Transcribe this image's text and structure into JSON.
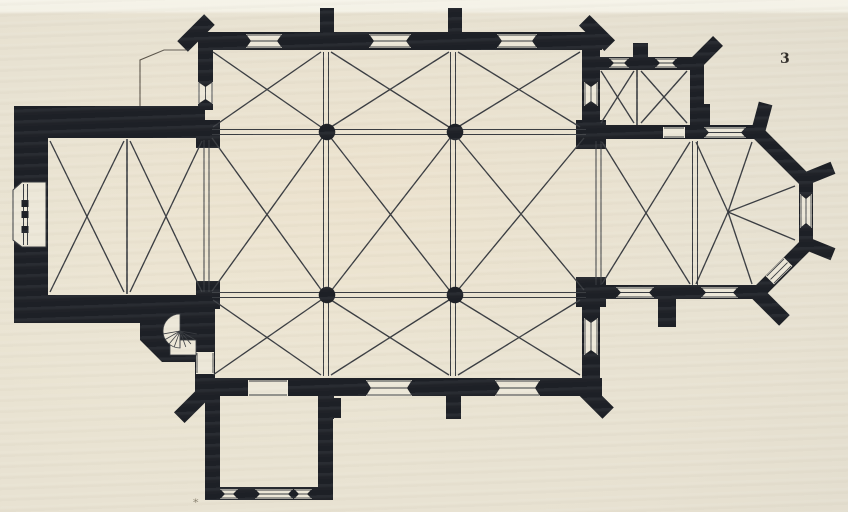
{
  "meta": {
    "figure_number": "3",
    "caption_mark": "*"
  },
  "colors": {
    "paper": "#e8e2d2",
    "paper_open": "#ece7d8",
    "ink": "#1d2026",
    "line": "#393c41",
    "outline": "#5a544a"
  },
  "plan": {
    "annex_outline": [
      "M140,108 L140,60 L164,50 L187,50"
    ],
    "walls_rects": [
      {
        "r": [
          14,
          106,
          34,
          217
        ],
        "n": "tower-west-wall"
      },
      {
        "r": [
          14,
          106,
          191,
          32
        ],
        "n": "tower-north-wall"
      },
      {
        "r": [
          14,
          295,
          186,
          28
        ],
        "n": "tower-south-wall"
      },
      {
        "r": [
          198,
          32,
          404,
          18
        ],
        "n": "nave-north-wall"
      },
      {
        "r": [
          198,
          44,
          15,
          66
        ],
        "n": "north-aisle-west-wall"
      },
      {
        "r": [
          582,
          44,
          18,
          84
        ],
        "n": "north-aisle-east-wall"
      },
      {
        "r": [
          596,
          57,
          108,
          13
        ],
        "n": "sacristy-north-wall"
      },
      {
        "r": [
          690,
          57,
          14,
          70
        ],
        "n": "sacristy-east-wall"
      },
      {
        "r": [
          596,
          125,
          166,
          14
        ],
        "n": "choir-north-wall"
      },
      {
        "r": [
          596,
          285,
          166,
          14
        ],
        "n": "choir-south-wall"
      },
      {
        "r": [
          198,
          378,
          404,
          18
        ],
        "n": "south-aisle-south-wall"
      },
      {
        "r": [
          195,
          295,
          20,
          97
        ],
        "n": "south-aisle-west-wall"
      },
      {
        "r": [
          582,
          296,
          18,
          88
        ],
        "n": "south-aisle-east-wall"
      },
      {
        "r": [
          205,
          390,
          15,
          110
        ],
        "n": "chapel-west-wall"
      },
      {
        "r": [
          318,
          390,
          15,
          110
        ],
        "n": "chapel-east-wall"
      },
      {
        "r": [
          205,
          487,
          128,
          13
        ],
        "n": "chapel-south-wall"
      },
      {
        "r": [
          320,
          8,
          14,
          26
        ],
        "n": "north-buttress-1"
      },
      {
        "r": [
          448,
          8,
          14,
          26
        ],
        "n": "north-buttress-2"
      },
      {
        "r": [
          633,
          43,
          15,
          16
        ],
        "n": "sacristy-buttress"
      },
      {
        "r": [
          694,
          104,
          16,
          23
        ],
        "n": "apse-north-buttress"
      },
      {
        "r": [
          658,
          297,
          18,
          30
        ],
        "n": "choir-south-buttress"
      },
      {
        "r": [
          319,
          396,
          15,
          23
        ],
        "n": "south-buttress-1"
      },
      {
        "r": [
          446,
          396,
          15,
          23
        ],
        "n": "south-buttress-2"
      },
      {
        "r": [
          331,
          398,
          10,
          20
        ],
        "n": "chapel-buttress-stub"
      }
    ],
    "piers": [
      {
        "r": [
          196,
          120,
          24,
          28
        ],
        "n": "west-respond-north"
      },
      {
        "r": [
          196,
          281,
          24,
          28
        ],
        "n": "west-respond-south"
      },
      {
        "r": [
          576,
          120,
          30,
          29
        ],
        "n": "chancel-pier-north"
      },
      {
        "r": [
          576,
          277,
          30,
          30
        ],
        "n": "chancel-pier-south"
      }
    ],
    "walls_polys": [
      {
        "p": "140,295 197,295 197,362 162,362 140,340",
        "n": "stair-turret"
      }
    ],
    "apse_wall": {
      "d": "M757,132 L806,181 L806,245 L757,294",
      "w": 14
    },
    "buttresses_rot": [
      {
        "b": [
          196,
          33,
          38,
          15,
          -45
        ],
        "n": "nave-nw-corner-buttress"
      },
      {
        "b": [
          597,
          33,
          36,
          15,
          45
        ],
        "n": "nave-ne-corner-buttress"
      },
      {
        "b": [
          706,
          53,
          34,
          14,
          -45
        ],
        "n": "sacristy-ne-corner-buttress"
      },
      {
        "b": [
          192,
          405,
          36,
          15,
          -45
        ],
        "n": "aisle-sw-corner-buttress"
      },
      {
        "b": [
          594,
          399,
          40,
          16,
          45
        ],
        "n": "aisle-se-corner-buttress"
      },
      {
        "b": [
          762,
          117,
          14,
          28,
          15
        ],
        "n": "apse-ne-buttress"
      },
      {
        "b": [
          820,
          173,
          28,
          13,
          -22
        ],
        "n": "apse-east-north-buttress"
      },
      {
        "b": [
          820,
          249,
          28,
          13,
          22
        ],
        "n": "apse-east-south-buttress"
      },
      {
        "b": [
          771,
          307,
          38,
          15,
          45
        ],
        "n": "apse-se-buttress"
      }
    ],
    "openings": [
      {
        "o": [
          246,
          34,
          36,
          14
        ],
        "axis": "h",
        "type": "window",
        "n": "north-window-1"
      },
      {
        "o": [
          369,
          34,
          42,
          14
        ],
        "axis": "h",
        "type": "window",
        "n": "north-window-2"
      },
      {
        "o": [
          497,
          34,
          40,
          14
        ],
        "axis": "h",
        "type": "window",
        "n": "north-window-3"
      },
      {
        "o": [
          198,
          82,
          15,
          22
        ],
        "axis": "v",
        "type": "window",
        "n": "aisle-west-window"
      },
      {
        "o": [
          584,
          82,
          14,
          24
        ],
        "axis": "v",
        "type": "window",
        "n": "aisle-east-window-north"
      },
      {
        "o": [
          609,
          58,
          20,
          10
        ],
        "axis": "h",
        "type": "window",
        "n": "sacristy-window-1"
      },
      {
        "o": [
          655,
          58,
          22,
          10
        ],
        "axis": "h",
        "type": "window",
        "n": "sacristy-window-2"
      },
      {
        "o": [
          663,
          127,
          22,
          11
        ],
        "axis": "h",
        "type": "door",
        "n": "sacristy-door"
      },
      {
        "o": [
          704,
          127,
          42,
          11
        ],
        "axis": "h",
        "type": "window",
        "n": "choir-north-window"
      },
      {
        "o": [
          800,
          194,
          12,
          34
        ],
        "axis": "v",
        "type": "window",
        "n": "apse-east-window"
      },
      {
        "o": [
          779,
          271,
          26,
          12
        ],
        "axis": "h",
        "type": "window",
        "a": -45,
        "n": "apse-se-window"
      },
      {
        "o": [
          616,
          287,
          38,
          11
        ],
        "axis": "h",
        "type": "window",
        "n": "choir-south-window-1"
      },
      {
        "o": [
          701,
          287,
          37,
          11
        ],
        "axis": "h",
        "type": "window",
        "n": "choir-south-window-2"
      },
      {
        "o": [
          584,
          318,
          14,
          37
        ],
        "axis": "v",
        "type": "window",
        "n": "aisle-east-window-south"
      },
      {
        "o": [
          248,
          380,
          40,
          16
        ],
        "axis": "h",
        "type": "door",
        "n": "chapel-door"
      },
      {
        "o": [
          366,
          380,
          46,
          16
        ],
        "axis": "h",
        "type": "window",
        "n": "south-window-1"
      },
      {
        "o": [
          495,
          380,
          45,
          16
        ],
        "axis": "h",
        "type": "window",
        "n": "south-window-2"
      },
      {
        "o": [
          196,
          352,
          18,
          22
        ],
        "axis": "v",
        "type": "door",
        "n": "stair-door"
      },
      {
        "o": [
          220,
          489,
          18,
          10
        ],
        "axis": "h",
        "type": "window",
        "n": "chapel-south-window-1"
      },
      {
        "o": [
          255,
          489,
          38,
          10
        ],
        "axis": "h",
        "type": "window",
        "n": "chapel-south-window-2"
      },
      {
        "o": [
          294,
          489,
          18,
          10
        ],
        "axis": "h",
        "type": "window",
        "n": "chapel-south-window-3"
      }
    ],
    "portal": {
      "poly": "13,190 22,182 46,182 46,247 22,247 13,240",
      "jamb_lines": [
        [
          23.5,
          184,
          23.5,
          245
        ],
        [
          27.5,
          184,
          27.5,
          245
        ]
      ],
      "blocks": [
        [
          21.5,
          200,
          7,
          7
        ],
        [
          21.5,
          211,
          7,
          7
        ],
        [
          21.5,
          226,
          7,
          7
        ]
      ]
    },
    "ribs": [
      [
        50,
        141,
        124,
        292
      ],
      [
        124,
        141,
        50,
        292
      ],
      [
        130,
        141,
        202,
        292
      ],
      [
        202,
        141,
        130,
        292
      ],
      [
        212,
        138,
        322,
        291
      ],
      [
        322,
        138,
        212,
        291
      ],
      [
        331,
        138,
        450,
        291
      ],
      [
        450,
        138,
        331,
        291
      ],
      [
        458,
        138,
        584,
        290
      ],
      [
        584,
        138,
        458,
        290
      ],
      [
        213,
        52,
        321,
        127
      ],
      [
        321,
        52,
        213,
        127
      ],
      [
        331,
        52,
        449,
        127
      ],
      [
        449,
        52,
        331,
        127
      ],
      [
        458,
        52,
        580,
        127
      ],
      [
        580,
        52,
        458,
        127
      ],
      [
        213,
        300,
        321,
        375
      ],
      [
        321,
        300,
        213,
        375
      ],
      [
        331,
        300,
        449,
        375
      ],
      [
        449,
        300,
        331,
        375
      ],
      [
        458,
        300,
        580,
        375
      ],
      [
        580,
        300,
        458,
        375
      ],
      [
        602,
        142,
        690,
        284
      ],
      [
        690,
        142,
        602,
        284
      ],
      [
        728,
        212,
        696,
        142
      ],
      [
        728,
        212,
        752,
        142
      ],
      [
        728,
        212,
        795,
        186
      ],
      [
        728,
        212,
        795,
        240
      ],
      [
        728,
        212,
        752,
        284
      ],
      [
        728,
        212,
        696,
        284
      ],
      [
        601,
        71,
        634,
        123
      ],
      [
        634,
        71,
        601,
        123
      ],
      [
        641,
        71,
        687,
        123
      ],
      [
        687,
        71,
        641,
        123
      ]
    ],
    "dividers": [
      [
        127,
        139,
        127,
        294
      ],
      [
        637,
        70,
        637,
        125
      ]
    ],
    "arches": [
      [
        206.5,
        140,
        206.5,
        292
      ],
      [
        326,
        138,
        326,
        290
      ],
      [
        453,
        138,
        453,
        290
      ],
      [
        326,
        52,
        326,
        127
      ],
      [
        453,
        52,
        453,
        127
      ],
      [
        326,
        300,
        326,
        376
      ],
      [
        453,
        300,
        453,
        376
      ],
      [
        212,
        132,
        586,
        132
      ],
      [
        212,
        295,
        586,
        295
      ],
      [
        598.5,
        141,
        598.5,
        285
      ],
      [
        695,
        141,
        695,
        285
      ]
    ],
    "columns": [
      {
        "c": [
          327,
          132
        ],
        "n": "nave-column-nw"
      },
      {
        "c": [
          455,
          132
        ],
        "n": "nave-column-ne"
      },
      {
        "c": [
          327,
          295
        ],
        "n": "nave-column-sw"
      },
      {
        "c": [
          455,
          295
        ],
        "n": "nave-column-se"
      }
    ],
    "column_radius": 8.3,
    "stair": {
      "cx": 180,
      "cy": 331,
      "r": 17,
      "landing": [
        170,
        340,
        26,
        15
      ],
      "spokes": [
        100,
        120,
        140,
        160,
        180,
        200,
        220,
        240,
        260
      ]
    }
  }
}
